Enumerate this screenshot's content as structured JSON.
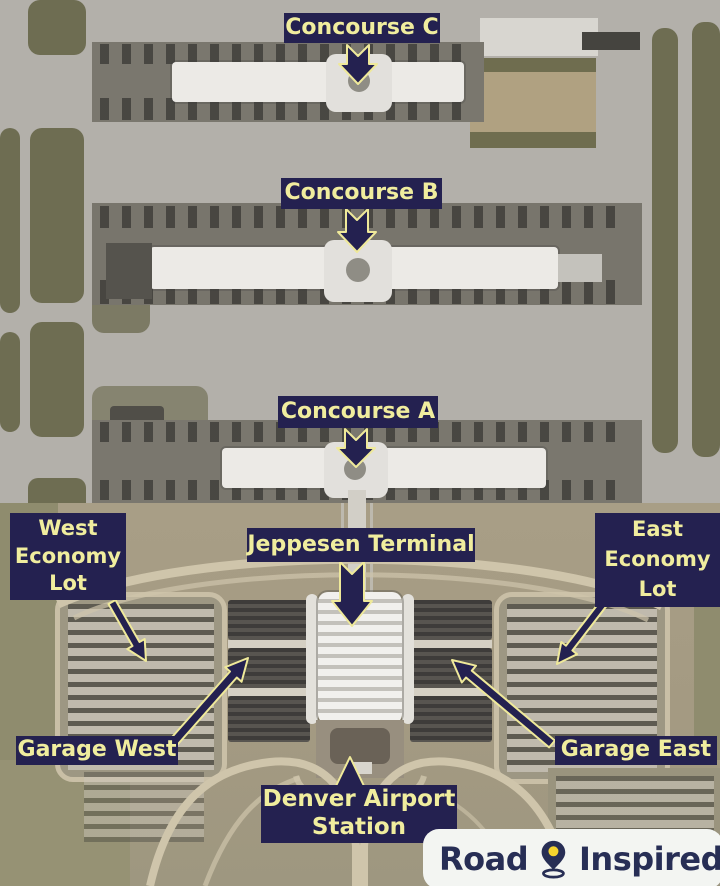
{
  "map": {
    "description": "Aerial satellite view of airport with concourses, terminal, parking lots and garages"
  },
  "labels": {
    "concourse_c": "Concourse C",
    "concourse_b": "Concourse B",
    "concourse_a": "Concourse A",
    "jeppesen_terminal": "Jeppesen Terminal",
    "west_economy_lot": [
      "West",
      "Economy",
      "Lot"
    ],
    "east_economy_lot": [
      "East",
      "Economy",
      "Lot"
    ],
    "garage_west": "Garage West",
    "garage_east": "Garage East",
    "denver_airport_station": [
      "Denver Airport",
      "Station"
    ]
  },
  "watermark": {
    "word_left": "Road",
    "word_right": "Inspired"
  },
  "colors": {
    "label_background": "#242150",
    "label_text": "#f0ed9e",
    "arrow_fill": "#242150",
    "arrow_outline": "#efe99a",
    "watermark_background": "#f3f5f2",
    "watermark_text": "#272e55",
    "watermark_pin_accent": "#f6d42e"
  }
}
